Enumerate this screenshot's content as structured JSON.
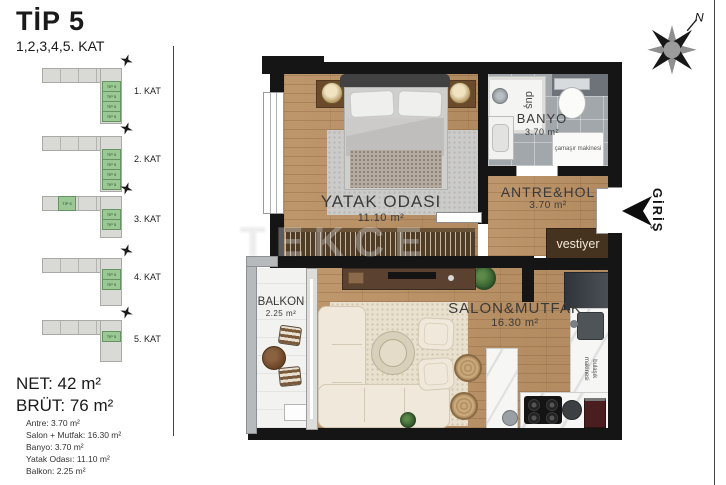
{
  "header": {
    "title": "TİP 5",
    "subtitle": "1,2,3,4,5. KAT"
  },
  "key_plans": {
    "unit_label": "TİP 5",
    "floors": [
      {
        "label": "1. KAT"
      },
      {
        "label": "2. KAT"
      },
      {
        "label": "3. KAT"
      },
      {
        "label": "4. KAT"
      },
      {
        "label": "5. KAT"
      }
    ]
  },
  "summary": {
    "net": "NET: 42 m²",
    "brut": "BRÜT: 76 m²",
    "rooms": [
      "Antre: 3.70 m²",
      "Salon + Mutfak: 16.30 m²",
      "Banyo: 3.70 m²",
      "Yatak Odası: 11.10 m²",
      "Balkon: 2.25 m²"
    ]
  },
  "plan": {
    "bedroom": {
      "name": "YATAK ODASI",
      "area": "11.10 m²"
    },
    "bathroom": {
      "name": "BANYO",
      "area": "3.70 m²",
      "shower": "duş",
      "washer": "çamaşır makinesi"
    },
    "hall": {
      "name": "ANTRE&HOL",
      "area": "3.70 m²",
      "wardrobe": "vestiyer"
    },
    "living": {
      "name": "SALON&MUTFAK",
      "area": "16.30 m²",
      "dishwasher": "bulaşık makinesi"
    },
    "balcony": {
      "name": "BALKON",
      "area": "2.25 m²"
    },
    "entrance": "GİRİŞ",
    "compass": "N",
    "watermark": "TEKCE"
  },
  "colors": {
    "wall": "#151515",
    "wood_floor": "#bb9164",
    "bath_tile": "#a2a7ab",
    "unit_green": "#9bc894",
    "wardrobe_brown": "#46331f",
    "marble": "#f6f6f4"
  }
}
